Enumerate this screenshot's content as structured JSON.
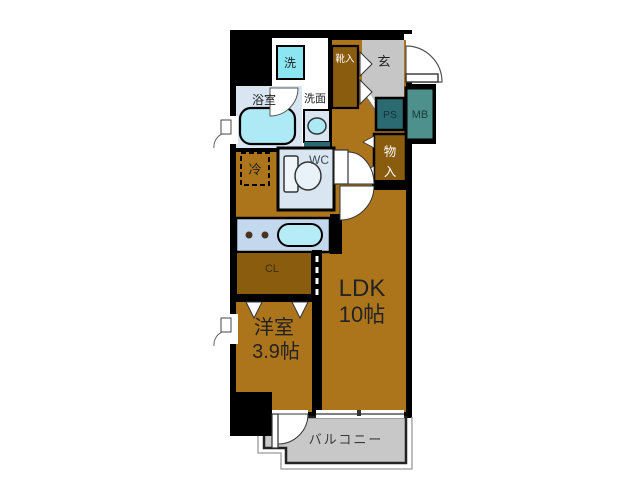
{
  "plan": {
    "title": "apartment-floor-plan",
    "rooms": {
      "ldk": {
        "name": "LDK",
        "size": "10帖"
      },
      "western_room": {
        "name": "洋室",
        "size": "3.9帖"
      },
      "balcony": {
        "name": "バルコニー"
      },
      "entrance": {
        "name": "玄"
      },
      "bathroom": {
        "name": "浴室"
      },
      "washroom": {
        "name": "洗面"
      },
      "toilet": {
        "name": "WC"
      },
      "closet": {
        "name": "CL"
      },
      "storage": {
        "name_top": "物",
        "name_bottom": "入"
      },
      "shoe_cabinet": {
        "name": "靴入"
      },
      "pipe_space": {
        "name": "PS"
      },
      "meter_box": {
        "name": "MB"
      }
    },
    "fixtures": {
      "washing_machine": {
        "name": "洗"
      },
      "refrigerator": {
        "name": "冷"
      }
    },
    "palette": {
      "wall": "#000000",
      "floor": "#ac751c",
      "closet_brown": "#8a5c0e",
      "water_room": "#d9e6f2",
      "fixture_cyan": "#aeeaf6",
      "counter_blue": "#c3d8ec",
      "genkan_gray": "#c6c6c6",
      "balcony_gray": "#c8c8c8",
      "ps_teal": "#2b6a71",
      "mb_teal": "#4e908c"
    }
  }
}
